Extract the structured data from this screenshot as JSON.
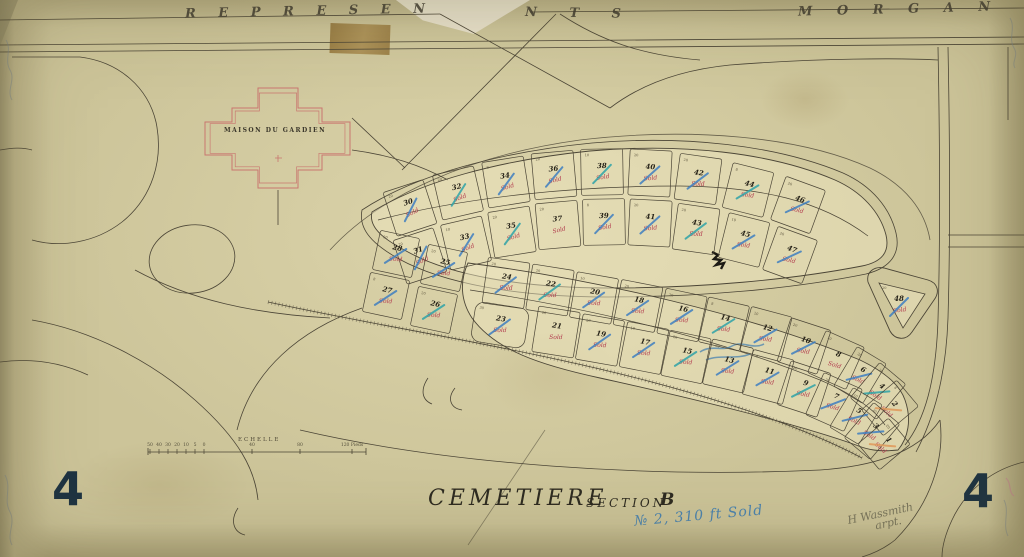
{
  "header": {
    "street_left": "R E P R E S E N",
    "street_mid": "N T S",
    "street_right": "M O R G A N"
  },
  "maison": {
    "label": "MAISON DU GARDIEN"
  },
  "titles": {
    "main": "CEMETIERE",
    "section": "SECTION",
    "letter": "B",
    "corner_left": "4",
    "corner_right": "4"
  },
  "scale": {
    "label": "ECHELLE",
    "ticks": [
      "50",
      "40",
      "30",
      "20",
      "10",
      "5",
      "0",
      "40",
      "80",
      "120 Pieds"
    ]
  },
  "notes": {
    "blue_note": "№ 2, 310 ft Sold",
    "signature": "H Wassmith",
    "signature2": "arpt.",
    "sold_label": "Sold"
  },
  "colors": {
    "ink": "#4b4536",
    "plot_number": "#262218",
    "sold_red": "#b23b4e",
    "maison_red": "#c9766f",
    "check_blue": "#3f7fc1",
    "check_teal": "#2fa3a8",
    "check_orange": "#e0995a"
  },
  "plots": {
    "list": [
      {
        "n": "30",
        "x": 410,
        "y": 208,
        "r": -18,
        "s": 1,
        "c": "b",
        "d": "20"
      },
      {
        "n": "32",
        "x": 458,
        "y": 193,
        "r": -13,
        "s": 1,
        "c": "t",
        "d": "20"
      },
      {
        "n": "34",
        "x": 506,
        "y": 182,
        "r": -9,
        "s": 1,
        "c": "b",
        "d": "8"
      },
      {
        "n": "36",
        "x": 554,
        "y": 175,
        "r": -5,
        "s": 1,
        "c": "b",
        "d": "20"
      },
      {
        "n": "38",
        "x": 602,
        "y": 172,
        "r": -1,
        "s": 1,
        "c": "t",
        "d": "10"
      },
      {
        "n": "40",
        "x": 650,
        "y": 173,
        "r": 3,
        "s": 1,
        "c": "b",
        "d": "20"
      },
      {
        "n": "42",
        "x": 698,
        "y": 179,
        "r": 8,
        "s": 1,
        "c": "b",
        "d": "20"
      },
      {
        "n": "44",
        "x": 748,
        "y": 190,
        "r": 14,
        "s": 1,
        "c": "t",
        "d": "8"
      },
      {
        "n": "46",
        "x": 798,
        "y": 205,
        "r": 20,
        "s": 1,
        "c": "b",
        "d": "20"
      },
      {
        "n": "31",
        "x": 420,
        "y": 256,
        "r": -18,
        "s": 1,
        "c": "b",
        "d": "20"
      },
      {
        "n": "33",
        "x": 466,
        "y": 243,
        "r": -13,
        "s": 1,
        "c": "b",
        "d": "10"
      },
      {
        "n": "35",
        "x": 512,
        "y": 232,
        "r": -9,
        "s": 1,
        "c": "t",
        "d": "20"
      },
      {
        "n": "37",
        "x": 558,
        "y": 225,
        "r": -5,
        "s": 1,
        "c": null,
        "d": "20"
      },
      {
        "n": "39",
        "x": 604,
        "y": 222,
        "r": -1,
        "s": 1,
        "c": "b",
        "d": "8"
      },
      {
        "n": "41",
        "x": 650,
        "y": 223,
        "r": 3,
        "s": 1,
        "c": "b",
        "d": "20"
      },
      {
        "n": "43",
        "x": 696,
        "y": 229,
        "r": 8,
        "s": 1,
        "c": "t",
        "d": "20"
      },
      {
        "n": "45",
        "x": 744,
        "y": 240,
        "r": 14,
        "s": 1,
        "c": "b",
        "d": "10"
      },
      {
        "n": "47",
        "x": 790,
        "y": 255,
        "r": 20,
        "s": 1,
        "c": "b",
        "d": "20"
      },
      {
        "n": "28",
        "x": 396,
        "y": 254,
        "r": 12,
        "s": 1,
        "c": "b",
        "d": "20",
        "w": 40,
        "h": 40
      },
      {
        "n": "25",
        "x": 444,
        "y": 268,
        "r": 12,
        "s": 1,
        "c": "b",
        "d": "20",
        "w": 40,
        "h": 40
      },
      {
        "n": "27",
        "x": 386,
        "y": 296,
        "r": 12,
        "s": 1,
        "c": "b",
        "d": "8",
        "w": 40,
        "h": 40
      },
      {
        "n": "26",
        "x": 434,
        "y": 310,
        "r": 12,
        "s": 1,
        "c": "t",
        "d": "20",
        "w": 40,
        "h": 40
      },
      {
        "n": "24",
        "x": 506,
        "y": 283,
        "r": 8,
        "s": 1,
        "c": "b",
        "d": "20"
      },
      {
        "n": "22",
        "x": 550,
        "y": 290,
        "r": 9,
        "s": 1,
        "c": "t",
        "d": "20"
      },
      {
        "n": "20",
        "x": 594,
        "y": 298,
        "r": 10,
        "s": 1,
        "c": "b",
        "d": "10"
      },
      {
        "n": "18",
        "x": 638,
        "y": 306,
        "r": 11,
        "s": 1,
        "c": "b",
        "d": "20"
      },
      {
        "n": "16",
        "x": 682,
        "y": 315,
        "r": 12,
        "s": 1,
        "c": "b",
        "d": "20"
      },
      {
        "n": "14",
        "x": 724,
        "y": 324,
        "r": 13,
        "s": 1,
        "c": "t",
        "d": "8"
      },
      {
        "n": "12",
        "x": 766,
        "y": 334,
        "r": 15,
        "s": 1,
        "c": "b",
        "d": "20"
      },
      {
        "n": "10",
        "x": 804,
        "y": 346,
        "r": 18,
        "s": 1,
        "c": "b",
        "d": "20"
      },
      {
        "n": "8",
        "x": 836,
        "y": 360,
        "r": 24,
        "s": 1,
        "c": null,
        "d": "10"
      },
      {
        "n": "6",
        "x": 860,
        "y": 375,
        "r": 31,
        "s": 1,
        "c": "b",
        "d": "20",
        "w": 34
      },
      {
        "n": "4",
        "x": 878,
        "y": 391,
        "r": 40,
        "s": 1,
        "c": "t",
        "d": "20",
        "w": 34
      },
      {
        "n": "2",
        "x": 890,
        "y": 408,
        "r": 50,
        "s": 1,
        "c": "o",
        "d": "8",
        "w": 34
      },
      {
        "n": "23",
        "x": 500,
        "y": 325,
        "r": 9,
        "s": 1,
        "c": "b",
        "d": "30",
        "w": 54,
        "h": 40,
        "rx": 9
      },
      {
        "n": "21",
        "x": 556,
        "y": 332,
        "r": 9,
        "s": 1,
        "c": null,
        "d": "20"
      },
      {
        "n": "19",
        "x": 600,
        "y": 340,
        "r": 10,
        "s": 1,
        "c": "b",
        "d": "20"
      },
      {
        "n": "17",
        "x": 644,
        "y": 348,
        "r": 11,
        "s": 1,
        "c": "b",
        "d": "10"
      },
      {
        "n": "15",
        "x": 686,
        "y": 357,
        "r": 12,
        "s": 1,
        "c": "t",
        "d": "20"
      },
      {
        "n": "13",
        "x": 728,
        "y": 366,
        "r": 13,
        "s": 1,
        "c": "b",
        "d": "20"
      },
      {
        "n": "11",
        "x": 768,
        "y": 377,
        "r": 15,
        "s": 1,
        "c": "b",
        "d": "8"
      },
      {
        "n": "9",
        "x": 804,
        "y": 389,
        "r": 18,
        "s": 1,
        "c": "t",
        "d": "20"
      },
      {
        "n": "7",
        "x": 834,
        "y": 402,
        "r": 24,
        "s": 1,
        "c": "b",
        "d": "20"
      },
      {
        "n": "5",
        "x": 856,
        "y": 416,
        "r": 31,
        "s": 1,
        "c": "b",
        "d": "10",
        "w": 34
      },
      {
        "n": "3",
        "x": 872,
        "y": 431,
        "r": 40,
        "s": 1,
        "c": "b",
        "d": "20",
        "w": 34
      },
      {
        "n": "1",
        "x": 884,
        "y": 444,
        "r": 50,
        "s": 1,
        "c": "o",
        "d": "20",
        "w": 34,
        "h": 40
      },
      {
        "n": "48",
        "x": 899,
        "y": 305,
        "r": 0,
        "s": 1,
        "c": "b",
        "d": "20",
        "tri": 1
      }
    ]
  }
}
